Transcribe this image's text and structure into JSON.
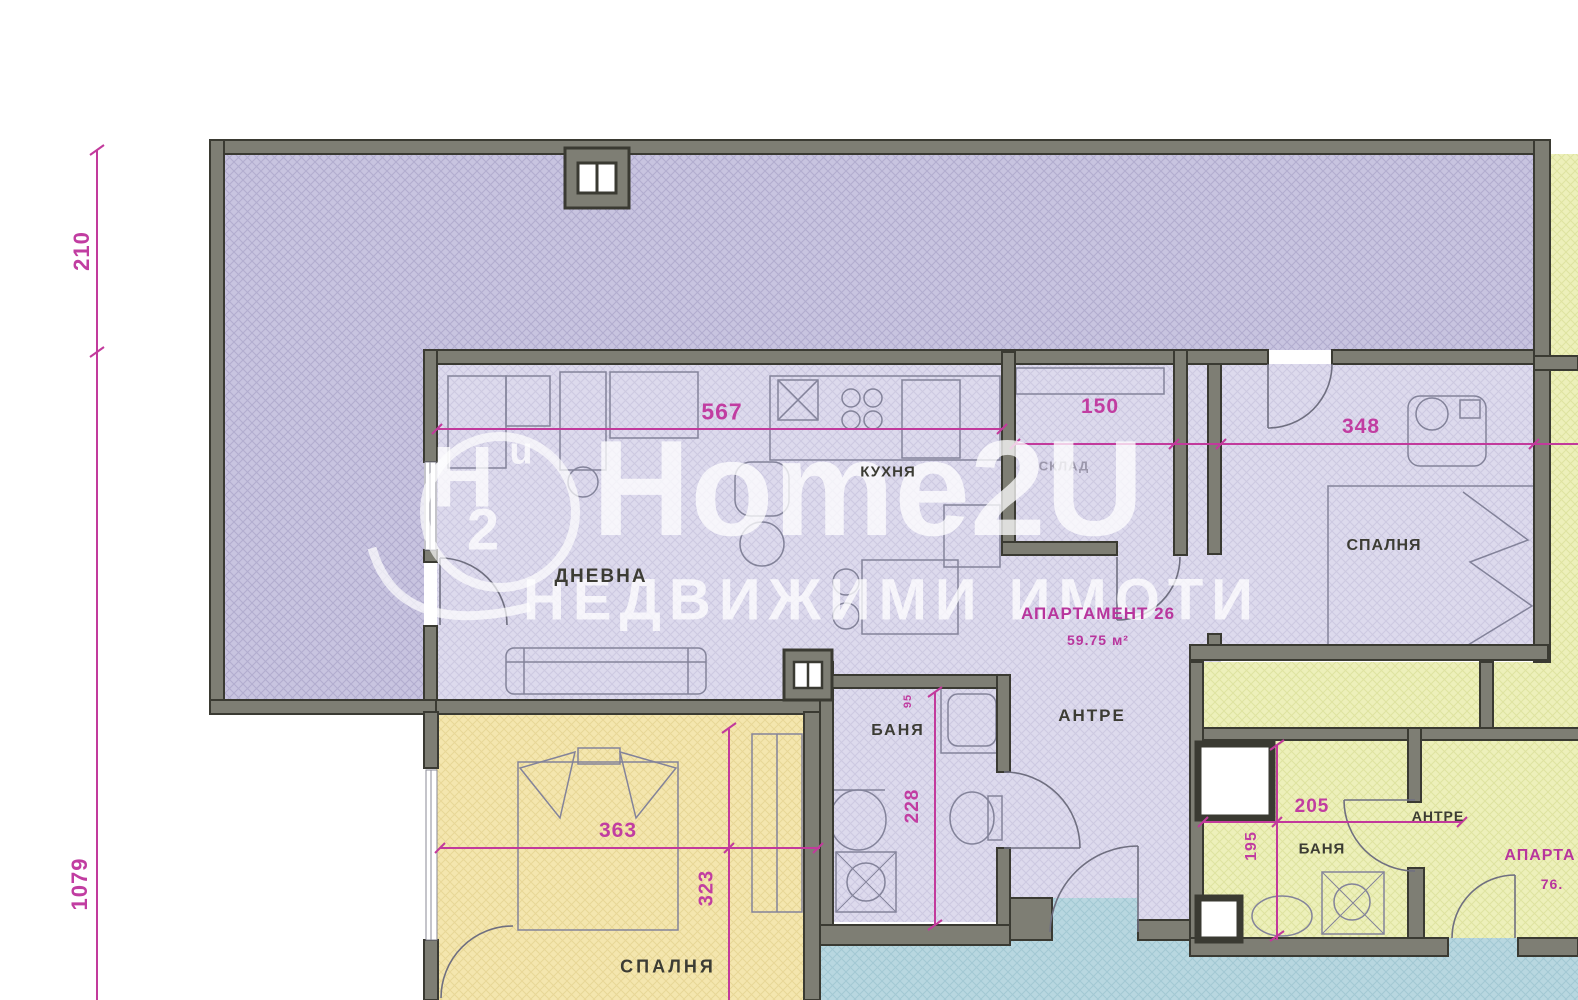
{
  "watermark": {
    "brand": "Home2U",
    "tagline": "НЕДВИЖИМИ ИМОТИ",
    "logo_main": "H",
    "logo_sup": "u",
    "logo_sub": "2"
  },
  "apartment_main": {
    "name": "АПАРТАМЕНТ 26",
    "area": "59.75 м²"
  },
  "apartment_adjacent": {
    "name_partial": "АПАРТА",
    "area_partial": "76."
  },
  "rooms": {
    "living": "ДНЕВНА",
    "kitchen": "КУХНЯ",
    "storage": "СКЛАД",
    "bedroom_right": "СПАЛНЯ",
    "hall": "АНТРЕ",
    "bath": "БАНЯ",
    "bedroom_bottom": "СПАЛНЯ",
    "bath_adjacent": "БАНЯ",
    "hall_adjacent": "АНТРЕ"
  },
  "dimensions_cm": {
    "terrace_depth": "210",
    "side_total": "1079",
    "living_width": "567",
    "storage_width": "150",
    "bedroom_right_width": "348",
    "bath_door": "95",
    "bath_depth": "228",
    "bedroom_bottom_width": "363",
    "bedroom_bottom_depth": "323",
    "bath_adjacent_width": "205",
    "bath_adjacent_depth": "195"
  },
  "colors": {
    "wall_fill": "#7e7e74",
    "wall_edge": "#3a3a32",
    "terrace_hatch": "#c7c3df",
    "interior_hatch": "#dcd9ec",
    "yellow_room": "#f4e6ad",
    "green_room": "#edf0ba",
    "blue_corridor": "#b8d7e0",
    "dimension_pink": "#c13da1",
    "label_dark": "#3c3c34",
    "watermark_white": "#ffffff"
  }
}
